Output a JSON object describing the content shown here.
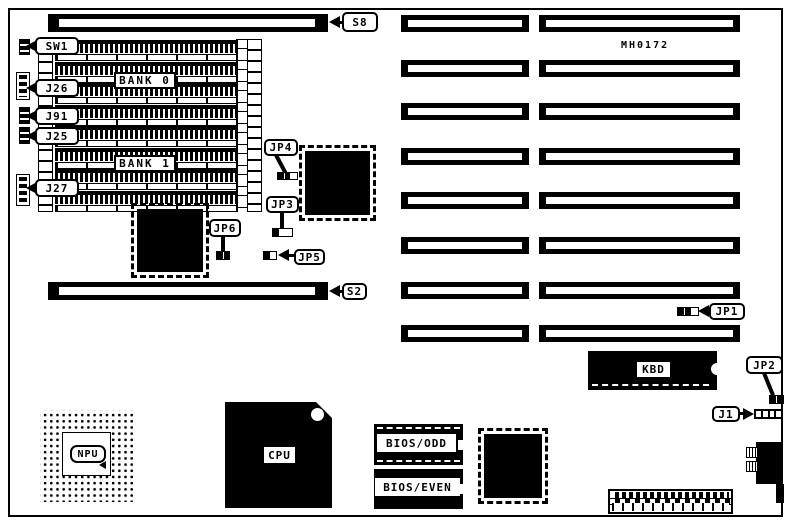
{
  "board": {
    "model": "MH0172",
    "memory": {
      "bank0_label": "BANK 0",
      "bank1_label": "BANK 1"
    },
    "callouts": {
      "s8": "S8",
      "sw1": "SW1",
      "j26": "J26",
      "j91": "J91",
      "j25": "J25",
      "j27": "J27",
      "jp4": "JP4",
      "jp3": "JP3",
      "jp6": "JP6",
      "jp5": "JP5",
      "s2": "S2",
      "jp1": "JP1",
      "jp2": "JP2",
      "j1": "J1"
    },
    "chips": {
      "kbd": "KBD",
      "npu": "NPU",
      "cpu": "CPU",
      "bios_odd": "BIOS/ODD",
      "bios_even": "BIOS/EVEN"
    },
    "colors": {
      "ink": "#000000",
      "paper": "#ffffff"
    }
  }
}
